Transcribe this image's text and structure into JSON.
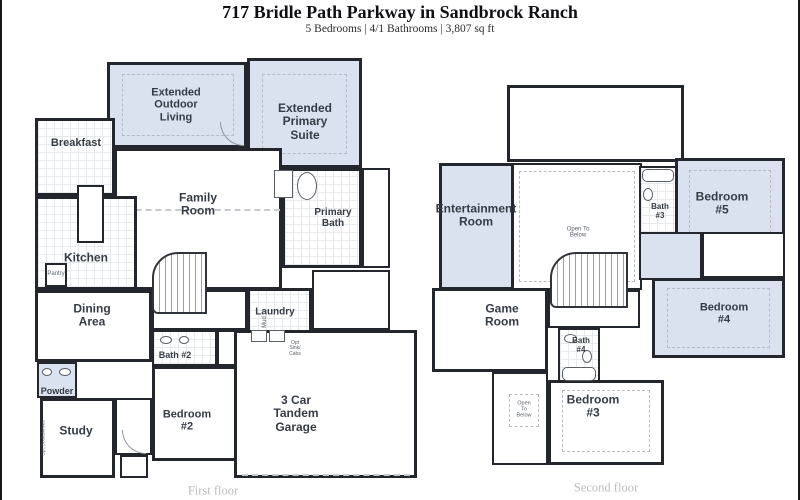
{
  "header": {
    "title": "717 Bridle Path Parkway in Sandbrock Ranch",
    "subtitle": "5 Bedrooms | 4/1 Bathrooms | 3,807 sq ft"
  },
  "colors": {
    "highlight": "#d9e2ee",
    "wall": "#23262d",
    "label": "#363c45",
    "caption": "#bcbcbc"
  },
  "first_floor": {
    "caption": "First floor",
    "rooms": {
      "extended_outdoor_living": "Extended\nOutdoor\nLiving",
      "extended_primary_suite": "Extended\nPrimary\nSuite",
      "breakfast": "Breakfast",
      "family_room": "Family\nRoom",
      "primary_bath": "Primary\nBath",
      "kitchen": "Kitchen",
      "pantry": "Pantry",
      "dining_area": "Dining\nArea",
      "laundry": "Laundry",
      "mud": "Mud",
      "opt_sink_cabs": "Opt\nSink/\nCabs",
      "bath_2": "Bath #2",
      "powder": "Powder",
      "study": "Study",
      "opt_bookshelves": "Opt. Bookshelves",
      "bedroom_2": "Bedroom\n#2",
      "garage": "3 Car\nTandem\nGarage"
    }
  },
  "second_floor": {
    "caption": "Second floor",
    "rooms": {
      "entertainment_room": "Entertainment\nRoom",
      "open_to_below_upper": "Open To\nBelow",
      "bath_3": "Bath\n#3",
      "bedroom_5": "Bedroom\n#5",
      "game_room": "Game\nRoom",
      "bath_4": "Bath\n#4",
      "bedroom_4": "Bedroom\n#4",
      "open_to_below_lower": "Open\nTo\nBelow",
      "bedroom_3": "Bedroom\n#3"
    }
  }
}
